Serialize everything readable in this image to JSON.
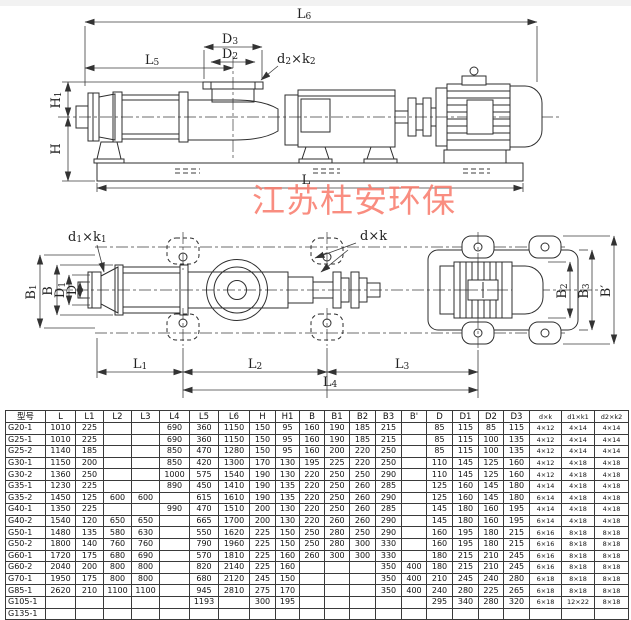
{
  "watermark": {
    "text": "江苏杜安环保",
    "color": "#f97a6b"
  },
  "dims": {
    "L6": {
      "base": "L",
      "sub": "6"
    },
    "D3": {
      "base": "D",
      "sub": "3"
    },
    "D2": {
      "base": "D",
      "sub": "2"
    },
    "L5": {
      "base": "L",
      "sub": "5"
    },
    "d2k2": {
      "p1": "d",
      "s1": "2",
      "p2": "×k",
      "s2": "2"
    },
    "H1": {
      "base": "H",
      "sub": "1"
    },
    "H": {
      "base": "H",
      "sub": ""
    },
    "L": {
      "base": "L",
      "sub": ""
    },
    "d1k1": {
      "p1": "d",
      "s1": "1",
      "p2": "×k",
      "s2": "1"
    },
    "dk": {
      "p1": "d",
      "s1": "",
      "p2": "×k",
      "s2": ""
    },
    "B1": {
      "base": "B",
      "sub": "1"
    },
    "B": {
      "base": "B",
      "sub": ""
    },
    "D1": {
      "base": "D",
      "sub": "1"
    },
    "D": {
      "base": "D",
      "sub": ""
    },
    "B2": {
      "base": "B",
      "sub": "2"
    },
    "B3": {
      "base": "B",
      "sub": "3"
    },
    "Bp": {
      "base": "B′",
      "sub": ""
    },
    "L1": {
      "base": "L",
      "sub": "1"
    },
    "L2": {
      "base": "L",
      "sub": "2"
    },
    "L3": {
      "base": "L",
      "sub": "3"
    },
    "L4": {
      "base": "L",
      "sub": "4"
    }
  },
  "table": {
    "headers": [
      "型号",
      "L",
      "L1",
      "L2",
      "L3",
      "L4",
      "L5",
      "L6",
      "H",
      "H1",
      "B",
      "B1",
      "B2",
      "B3",
      "B'",
      "D",
      "D1",
      "D2",
      "D3",
      "d×k",
      "d1×k1",
      "d2×k2"
    ],
    "rows": [
      [
        "G20-1",
        "1010",
        "225",
        "",
        "",
        "690",
        "360",
        "1150",
        "150",
        "95",
        "160",
        "190",
        "185",
        "215",
        "",
        "85",
        "115",
        "85",
        "115",
        "4×12",
        "4×14",
        "4×14"
      ],
      [
        "G25-1",
        "1010",
        "225",
        "",
        "",
        "690",
        "360",
        "1150",
        "150",
        "95",
        "160",
        "190",
        "185",
        "215",
        "",
        "85",
        "115",
        "100",
        "135",
        "4×12",
        "4×14",
        "4×14"
      ],
      [
        "G25-2",
        "1140",
        "185",
        "",
        "",
        "850",
        "470",
        "1280",
        "150",
        "95",
        "160",
        "200",
        "220",
        "250",
        "",
        "85",
        "115",
        "100",
        "135",
        "4×12",
        "4×14",
        "4×14"
      ],
      [
        "G30-1",
        "1150",
        "200",
        "",
        "",
        "850",
        "420",
        "1300",
        "170",
        "130",
        "195",
        "225",
        "220",
        "250",
        "",
        "110",
        "145",
        "125",
        "160",
        "4×12",
        "4×18",
        "4×18"
      ],
      [
        "G30-2",
        "1360",
        "250",
        "",
        "",
        "1000",
        "575",
        "1540",
        "190",
        "130",
        "220",
        "250",
        "250",
        "290",
        "",
        "110",
        "145",
        "125",
        "160",
        "4×12",
        "4×18",
        "4×18"
      ],
      [
        "G35-1",
        "1230",
        "225",
        "",
        "",
        "890",
        "450",
        "1410",
        "190",
        "135",
        "220",
        "250",
        "260",
        "285",
        "",
        "125",
        "160",
        "145",
        "180",
        "4×14",
        "4×18",
        "4×18"
      ],
      [
        "G35-2",
        "1450",
        "125",
        "600",
        "600",
        "",
        "615",
        "1610",
        "190",
        "135",
        "220",
        "250",
        "260",
        "290",
        "",
        "125",
        "160",
        "145",
        "180",
        "6×14",
        "4×18",
        "4×18"
      ],
      [
        "G40-1",
        "1350",
        "225",
        "",
        "",
        "990",
        "470",
        "1510",
        "200",
        "130",
        "220",
        "250",
        "260",
        "285",
        "",
        "145",
        "180",
        "160",
        "195",
        "4×14",
        "4×18",
        "4×18"
      ],
      [
        "G40-2",
        "1540",
        "120",
        "650",
        "650",
        "",
        "665",
        "1700",
        "200",
        "130",
        "220",
        "260",
        "260",
        "290",
        "",
        "145",
        "180",
        "160",
        "195",
        "6×14",
        "4×18",
        "4×18"
      ],
      [
        "G50-1",
        "1480",
        "135",
        "580",
        "630",
        "",
        "550",
        "1620",
        "225",
        "150",
        "250",
        "280",
        "250",
        "290",
        "",
        "160",
        "195",
        "180",
        "215",
        "6×16",
        "8×18",
        "8×18"
      ],
      [
        "G50-2",
        "1800",
        "140",
        "760",
        "760",
        "",
        "790",
        "1960",
        "225",
        "150",
        "250",
        "280",
        "300",
        "330",
        "",
        "160",
        "195",
        "180",
        "215",
        "6×16",
        "8×18",
        "8×18"
      ],
      [
        "G60-1",
        "1720",
        "175",
        "680",
        "690",
        "",
        "570",
        "1810",
        "225",
        "160",
        "260",
        "300",
        "300",
        "330",
        "",
        "180",
        "215",
        "210",
        "245",
        "6×16",
        "8×18",
        "8×18"
      ],
      [
        "G60-2",
        "2040",
        "200",
        "800",
        "800",
        "",
        "820",
        "2140",
        "225",
        "160",
        "",
        "",
        "",
        "350",
        "400",
        "180",
        "215",
        "210",
        "245",
        "6×16",
        "8×18",
        "8×18"
      ],
      [
        "G70-1",
        "1950",
        "175",
        "800",
        "800",
        "",
        "680",
        "2120",
        "245",
        "150",
        "",
        "",
        "",
        "350",
        "400",
        "210",
        "245",
        "240",
        "280",
        "6×18",
        "8×18",
        "8×18"
      ],
      [
        "G85-1",
        "2620",
        "210",
        "1100",
        "1100",
        "",
        "945",
        "2810",
        "275",
        "170",
        "",
        "",
        "",
        "350",
        "400",
        "240",
        "280",
        "225",
        "265",
        "6×18",
        "8×18",
        "8×18"
      ],
      [
        "G105-1",
        "",
        "",
        "",
        "",
        "",
        "1193",
        "",
        "300",
        "195",
        "",
        "",
        "",
        "",
        "",
        "295",
        "340",
        "280",
        "320",
        "6×18",
        "12×22",
        "8×18"
      ],
      [
        "G135-1",
        "",
        "",
        "",
        "",
        "",
        "",
        "",
        "",
        "",
        "",
        "",
        "",
        "",
        "",
        "",
        "",
        "",
        "",
        "",
        "",
        ""
      ]
    ]
  }
}
